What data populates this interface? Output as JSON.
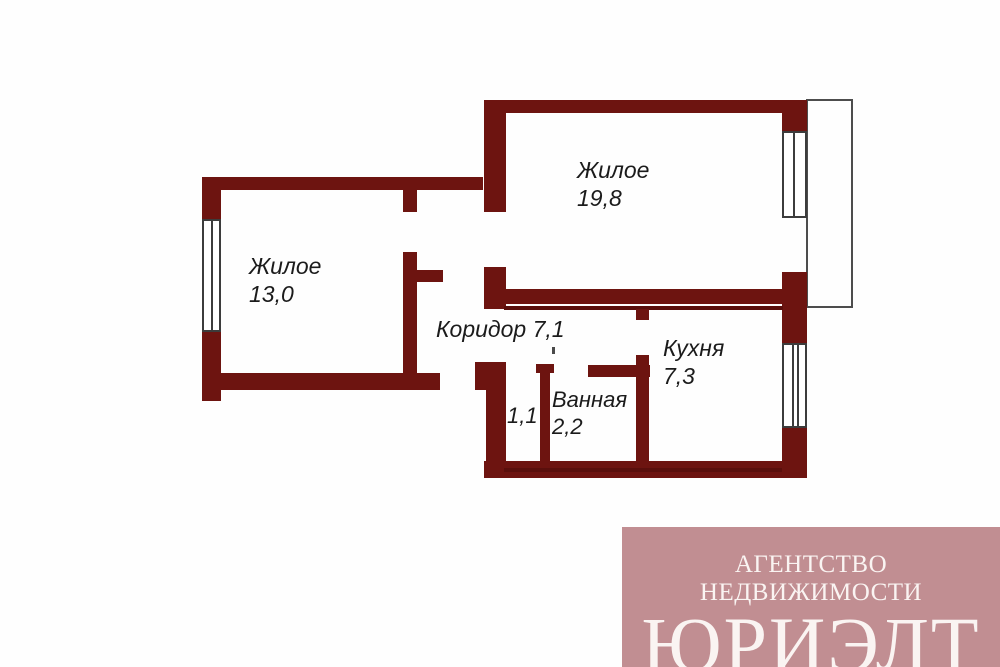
{
  "colors": {
    "wall": "#6d1410",
    "wallDark": "#5a0f0c",
    "frame": "#3c3c3c",
    "balconyLine": "#4d4d4d",
    "labelColor": "#1b1b1b",
    "wmBg": "#c18e92",
    "wmFg": "#faf4f2"
  },
  "rooms": {
    "living19": {
      "name": "Жилое",
      "area": "19,8"
    },
    "living13": {
      "name": "Жилое",
      "area": "13,0"
    },
    "corridor": {
      "label": "Коридор 7,1"
    },
    "kitchen": {
      "name": "Кухня",
      "area": "7,3"
    },
    "bathroom": {
      "name": "Ванная",
      "area": "2,2"
    },
    "wc": {
      "area": "1,1"
    }
  },
  "watermark": {
    "line1": "АГЕНТСТВО НЕДВИЖИМОСТИ",
    "line2": "ЮРИЭЛТ"
  }
}
